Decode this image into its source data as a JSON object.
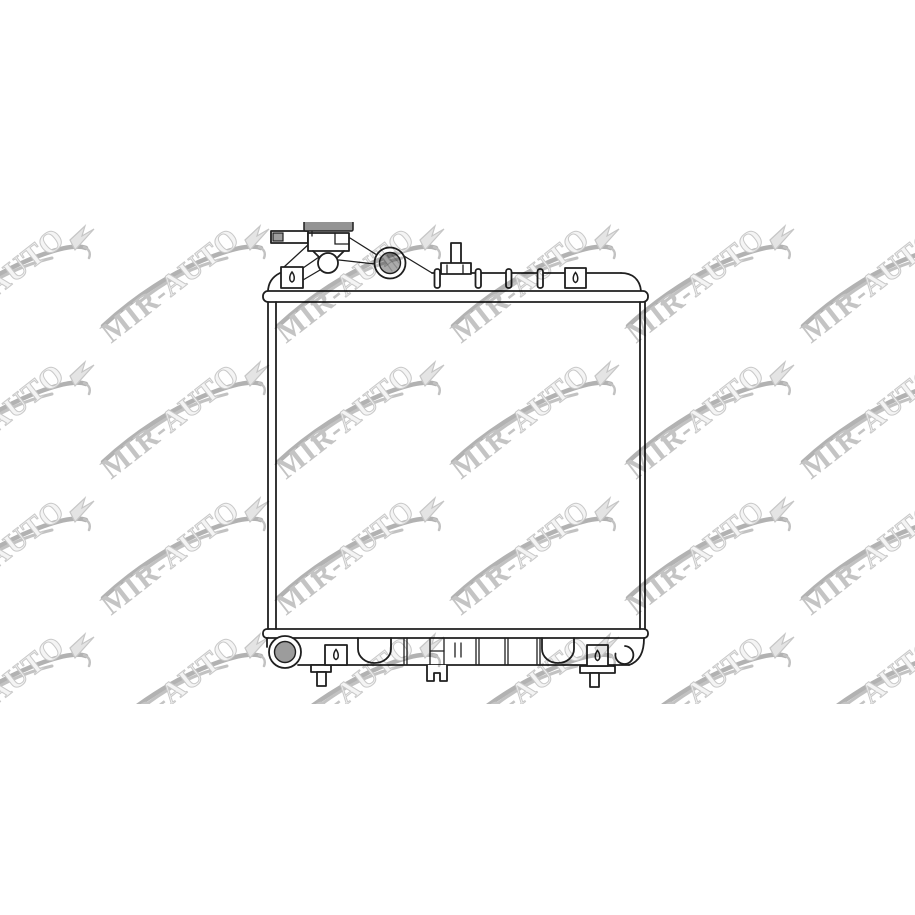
{
  "page": {
    "background_color": "#ffffff"
  },
  "product_image": {
    "alt": "radiator technical line drawing"
  },
  "watermark": {
    "text": "MIR-AUTO",
    "text_prefix": "MIR-",
    "text_suffix": "AUTO",
    "rows": 4,
    "cols": 6,
    "tile_period_x": 175,
    "tile_period_y": 136,
    "origin_x": -74,
    "origin_y": 0,
    "band_top": 222,
    "band_height": 482,
    "colors": {
      "swoosh": "#b2b2b2",
      "roof": "#c2c2c2",
      "text_solid": "#c4c4c4",
      "text_outline_fill": "#f4f4f4",
      "text_outline_stroke": "#c9c9c9",
      "pennant_fill": "#e4e4e4",
      "pennant_stroke": "#c6c6c6"
    }
  },
  "drawing": {
    "line_color": "#1f1f1f",
    "face_fill": "#ffffff",
    "cap_fill": "#949494",
    "tube_tip_fill": "#9e9e9e",
    "inlet_fill": "#ababab",
    "inlet_hatch": "#8d8d8d",
    "outlet_fill": "#9c9c9c"
  }
}
